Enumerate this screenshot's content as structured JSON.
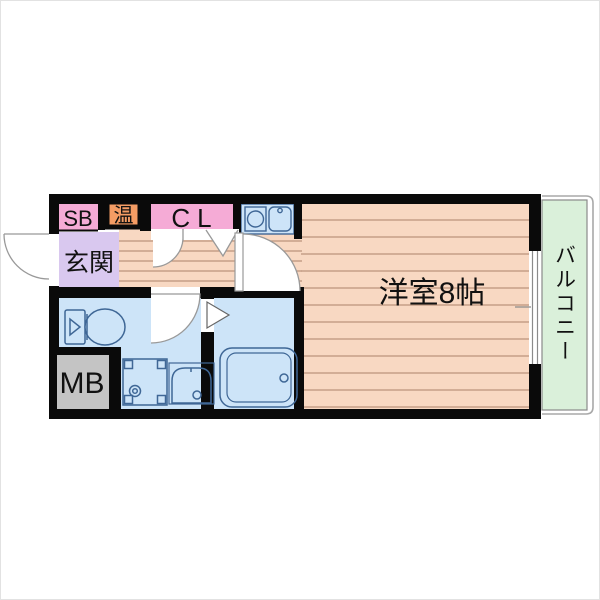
{
  "floorplan": {
    "type": "apartment-floor-plan",
    "labels": {
      "shoe_box": "SB",
      "water_heater": "温",
      "closet": "CL",
      "entrance": "玄関",
      "western_room": "洋室8帖",
      "balcony": "バルコニー",
      "meter_box": "MB"
    },
    "colors": {
      "wall": "#0a0a0a",
      "floor_peach": "#f8d8c2",
      "floor_stripe": "#bb937b",
      "closet_pink": "#f5abd6",
      "water_heater_orange": "#f49c64",
      "entrance_purple": "#d9c8ef",
      "wet_area_blue": "#cde4f8",
      "kitchen_blue": "#cde4f8",
      "balcony_green": "#daf0da",
      "meter_box_gray": "#c4c4c4",
      "fixture_outline_blue": "#3f6796",
      "door_line_gray": "#999999",
      "balcony_outline_gray": "#8a8a8a"
    },
    "icons": [
      "entrance-door-swing-icon",
      "closet-door-swing-icon",
      "closet-folding-door-icon",
      "room-door-swing-icon",
      "washroom-door-swing-icon",
      "bathroom-door-icon",
      "kitchen-unit-icon",
      "toilet-icon",
      "washing-machine-pan-icon",
      "wash-basin-icon",
      "bathtub-icon",
      "balcony-window-icon"
    ]
  }
}
